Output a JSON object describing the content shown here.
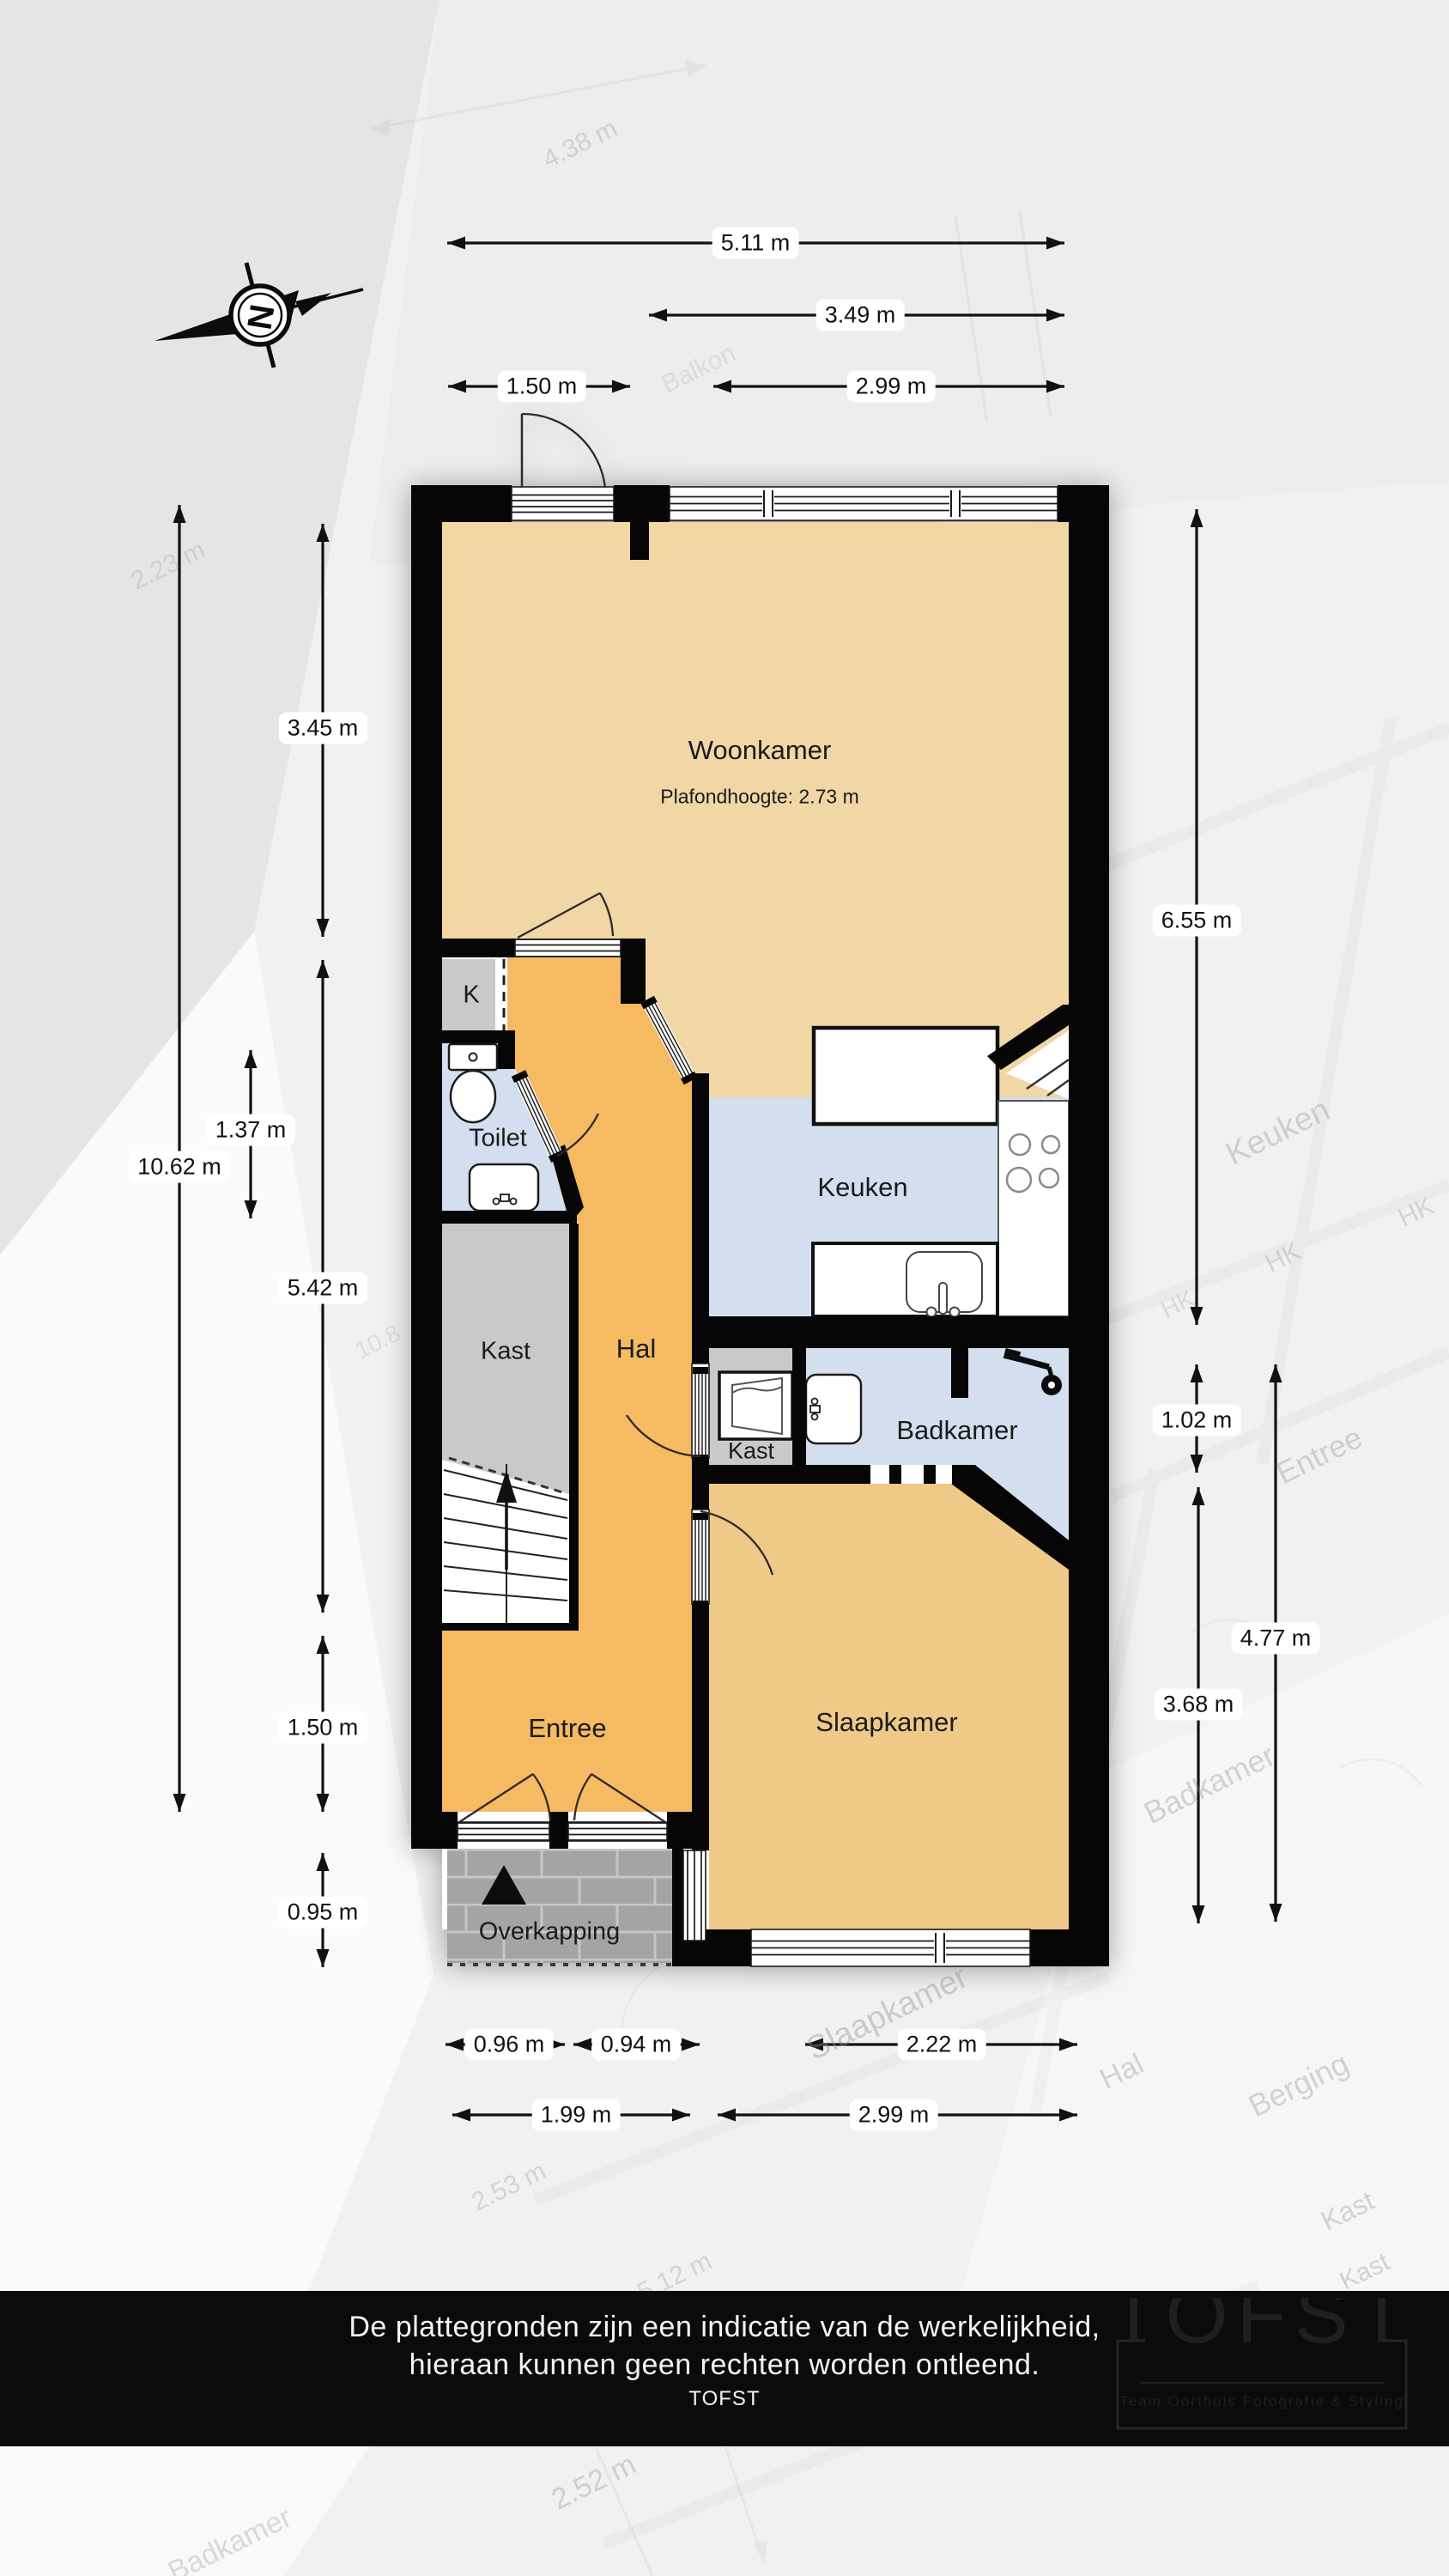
{
  "compass": {
    "letter": "N"
  },
  "rooms": {
    "woonkamer": {
      "label": "Woonkamer",
      "ceiling": "Plafondhoogte: 2.73 m"
    },
    "keuken": {
      "label": "Keuken"
    },
    "toilet": {
      "label": "Toilet"
    },
    "meterkast": {
      "label": "K"
    },
    "kast": {
      "label": "Kast"
    },
    "hal": {
      "label": "Hal"
    },
    "kast_klein": {
      "label": "Kast"
    },
    "badkamer": {
      "label": "Badkamer"
    },
    "slaapkamer": {
      "label": "Slaapkamer"
    },
    "entree": {
      "label": "Entree"
    },
    "overkapping": {
      "label": "Overkapping"
    }
  },
  "dimensions": {
    "top": [
      {
        "label": "5.11 m"
      },
      {
        "label": "3.49 m"
      },
      {
        "label": "1.50 m"
      },
      {
        "label": "2.99 m"
      }
    ],
    "left": [
      {
        "label": "3.45 m"
      },
      {
        "label": "10.62 m"
      },
      {
        "label": "1.37 m"
      },
      {
        "label": "5.42 m"
      },
      {
        "label": "1.50 m"
      },
      {
        "label": "0.95 m"
      }
    ],
    "right": [
      {
        "label": "6.55 m"
      },
      {
        "label": "1.02 m"
      },
      {
        "label": "4.77 m"
      },
      {
        "label": "3.68 m"
      }
    ],
    "bottom": [
      {
        "label": "0.96 m"
      },
      {
        "label": "0.94 m"
      },
      {
        "label": "2.22 m"
      },
      {
        "label": "1.99 m"
      },
      {
        "label": "2.99 m"
      }
    ]
  },
  "footer": {
    "line1": "De plattegronden zijn een indicatie van de werkelijkheid,",
    "line2": "hieraan kunnen geen rechten worden ontleend.",
    "brand": "TOFST"
  },
  "logo": {
    "title": "TOFST",
    "subtitle": "Team Oorthuis Fotografie & Styling"
  },
  "watermark": {
    "items": [
      {
        "text": "4.38 m"
      },
      {
        "text": "Balkon"
      },
      {
        "text": "2.23 m"
      },
      {
        "text": "Keuken"
      },
      {
        "text": "HK"
      },
      {
        "text": "HK"
      },
      {
        "text": "HK"
      },
      {
        "text": "Entree"
      },
      {
        "text": "10.8"
      },
      {
        "text": "Badkamer"
      },
      {
        "text": "Slaapkamer"
      },
      {
        "text": "Hal"
      },
      {
        "text": "Berging"
      },
      {
        "text": "Kast"
      },
      {
        "text": "Kast"
      },
      {
        "text": "2.53 m"
      },
      {
        "text": "5.12 m"
      },
      {
        "text": "2.52 m"
      },
      {
        "text": "Badkamer"
      }
    ]
  },
  "colors": {
    "wall": "#060606",
    "woonkamer": "#f1d6a6",
    "slaapkamer": "#efc987",
    "hal": "#f5ba62",
    "wet": "#d3dfee",
    "kast": "#c8c8c8",
    "tile": "#a4a4a4",
    "footer_bg": "#0b0b0b"
  }
}
